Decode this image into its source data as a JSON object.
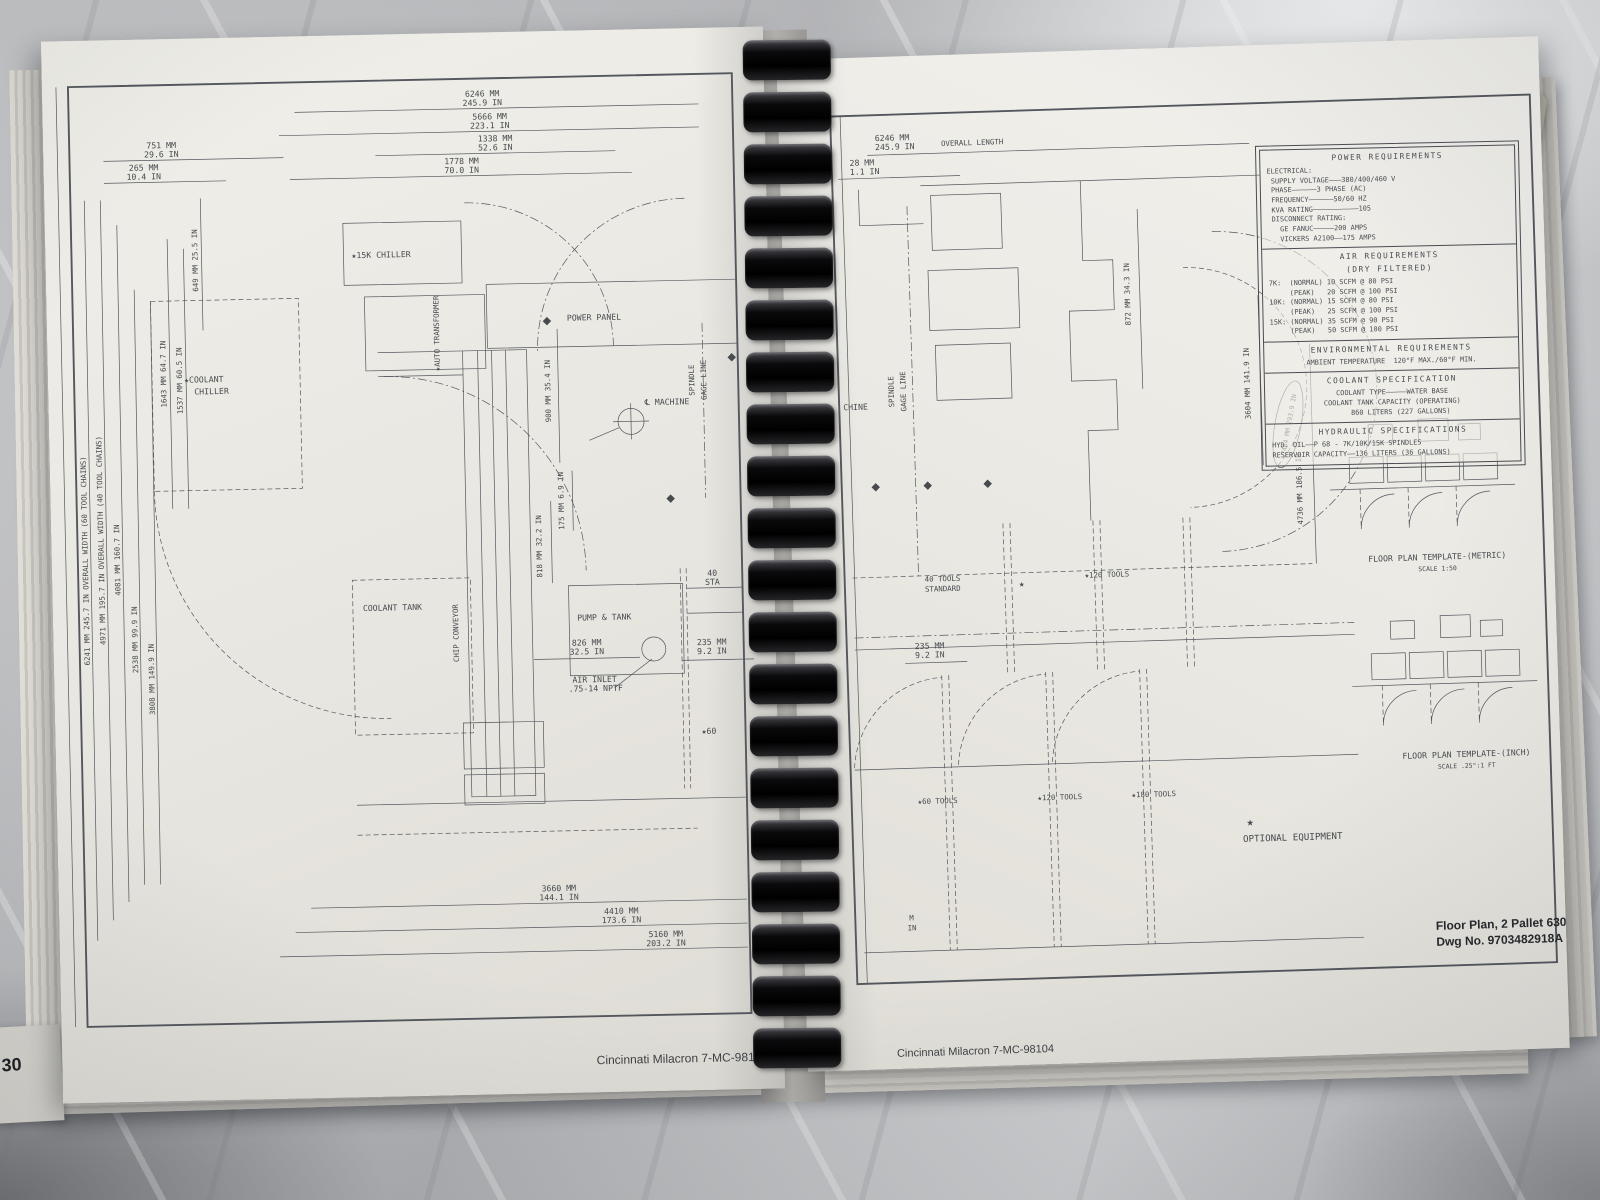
{
  "left_page": {
    "footer": "Cincinnati Milacron  7-MC-98104",
    "page_number": "30",
    "labels": {
      "chiller_15k": "★15K CHILLER",
      "coolant_chiller_1": "★COOLANT",
      "coolant_chiller_2": "CHILLER",
      "auto_transformer": "★AUTO TRANSFORMER",
      "power_panel": "POWER PANEL",
      "machine_centerline": "℄ MACHINE",
      "spindle_1": "SPINDLE",
      "spindle_2": "GAGE LINE",
      "coolant_tank": "COOLANT TANK",
      "chip_conveyor": "CHIP CONVEYOR",
      "pump_tank": "PUMP & TANK",
      "air_inlet_1": "AIR INLET",
      "air_inlet_2": ".75-14 NPTF",
      "sta_40_1": "40",
      "sta_40_2": "STA",
      "star_60": "★60"
    },
    "dims": {
      "top_6246_mm": "6246 MM",
      "top_6246_in": "245.9 IN",
      "top_5666_mm": "5666 MM",
      "top_5666_in": "223.1 IN",
      "top_1338_mm": "1338 MM",
      "top_1338_in": "52.6 IN",
      "top_751_mm": "751 MM",
      "top_751_in": "29.6 IN",
      "top_265_mm": "265 MM",
      "top_265_in": "10.4 IN",
      "top_1778_mm": "1778 MM",
      "top_1778_in": "70.0 IN",
      "left_649": "649 MM  25.5 IN",
      "left_6241": "6241 MM  245.7 IN OVERALL WIDTH (60 TOOL CHAINS)",
      "left_4971": "4971 MM  195.7 IN OVERALL WIDTH (40 TOOL CHAINS)",
      "left_4081": "4081 MM  160.7 IN",
      "left_2538": "2538 MM  99.9 IN",
      "left_3808": "3808 MM  149.9 IN",
      "left_1643": "1643 MM  64.7 IN",
      "left_1537": "1537 MM  60.5 IN",
      "mid_900": "900 MM  35.4 IN",
      "mid_175": "175 MM  6.9 IN",
      "mid_818": "818 MM  32.2 IN",
      "mid_826_mm": "826 MM",
      "mid_826_in": "32.5 IN",
      "right_235_mm": "235 MM",
      "right_235_in": "9.2 IN",
      "bot_3660_mm": "3660 MM",
      "bot_3660_in": "144.1 IN",
      "bot_4410_mm": "4410 MM",
      "bot_4410_in": "173.6 IN",
      "bot_5160_mm": "5160 MM",
      "bot_5160_in": "203.2 IN"
    }
  },
  "right_page": {
    "footer": "Cincinnati Milacron  7-MC-98104",
    "corner_partial": "Pa",
    "title_block": {
      "line1": "Floor Plan, 2 Pallet  630D",
      "line2": "Dwg No. 9703482918A (Sht"
    },
    "tables": {
      "power": {
        "title": "POWER REQUIREMENTS",
        "rows": [
          "ELECTRICAL:",
          " SUPPLY VOLTAGE———380/400/460 V",
          " PHASE——————3 PHASE (AC)",
          " FREQUENCY——————50/60 HZ",
          " KVA RATING———————————105",
          " DISCONNECT RATING:",
          "   GE FANUC—————200 AMPS",
          "   VICKERS A2100——175 AMPS"
        ]
      },
      "air": {
        "title1": "AIR REQUIREMENTS",
        "title2": "(DRY FILTERED)",
        "rows": [
          "7K:  (NORMAL) 10 SCFM @ 80 PSI",
          "     (PEAK)   20 SCFM @ 100 PSI",
          "10K: (NORMAL) 15 SCFM @ 80 PSI",
          "     (PEAK)   25 SCFM @ 100 PSI",
          "15K: (NORMAL) 35 SCFM @ 90 PSI",
          "     (PEAK)   50 SCFM @ 100 PSI"
        ]
      },
      "environmental": {
        "title": "ENVIRONMENTAL REQUIREMENTS",
        "rows": [
          "AMBIENT TEMPERATURE  120°F MAX./60°F MIN."
        ]
      },
      "coolant": {
        "title": "COOLANT SPECIFICATION",
        "rows": [
          "COOLANT TYPE—————WATER BASE",
          "COOLANT TANK CAPACITY (OPERATING)",
          "    860 LITERS (227 GALLONS)"
        ]
      },
      "hydraulic": {
        "title": "HYDRAULIC SPECIFICATIONS",
        "rows": [
          "HYD. OIL——P 68 - 7K/10K/15K SPINDLES",
          "RESERVOIR CAPACITY——136 LITERS (36 GALLONS)"
        ]
      }
    },
    "labels": {
      "machine_partial": "CHINE",
      "spindle_1": "SPINDLE",
      "spindle_2": "GAGE LINE",
      "tools_40_1": "40 TOOLS",
      "tools_40_2": "STANDARD",
      "star": "★",
      "tools_120_top": "★120 TOOLS",
      "tools_60": "★60 TOOLS",
      "tools_120": "★120 TOOLS",
      "tools_180": "★180 TOOLS",
      "optional_star": "★",
      "optional_equipment": "OPTIONAL EQUIPMENT",
      "template_metric": "FLOOR PLAN TEMPLATE-(METRIC)",
      "template_metric_scale": "SCALE 1:50",
      "template_inch": "FLOOR PLAN TEMPLATE-(INCH)",
      "template_inch_scale": "SCALE .25\":1 FT"
    },
    "dims": {
      "overall_mm": "6246 MM",
      "overall_in": "245.9 IN",
      "overall_note": "OVERALL LENGTH",
      "small_mm": "28 MM",
      "small_in": "1.1 IN",
      "d235_mm": "235 MM",
      "d235_in": "9.2 IN",
      "v872": "872 MM  34.3 IN",
      "v3604": "3604 MM  141.9 IN",
      "v7464": "7464 MM  293.9 IN",
      "v4736": "4736 MM  186.5 IN",
      "partial_m": "M",
      "partial_in": "IN"
    }
  },
  "side": {
    "index_tab": "INDEX",
    "handwritten": "Teste"
  },
  "colors": {
    "ink": "#54575d",
    "page": "#eae8e2",
    "marble": "#c0c1c4",
    "handwriting_blue": "#3b56a8",
    "binding_black": "#0a0a0c"
  }
}
